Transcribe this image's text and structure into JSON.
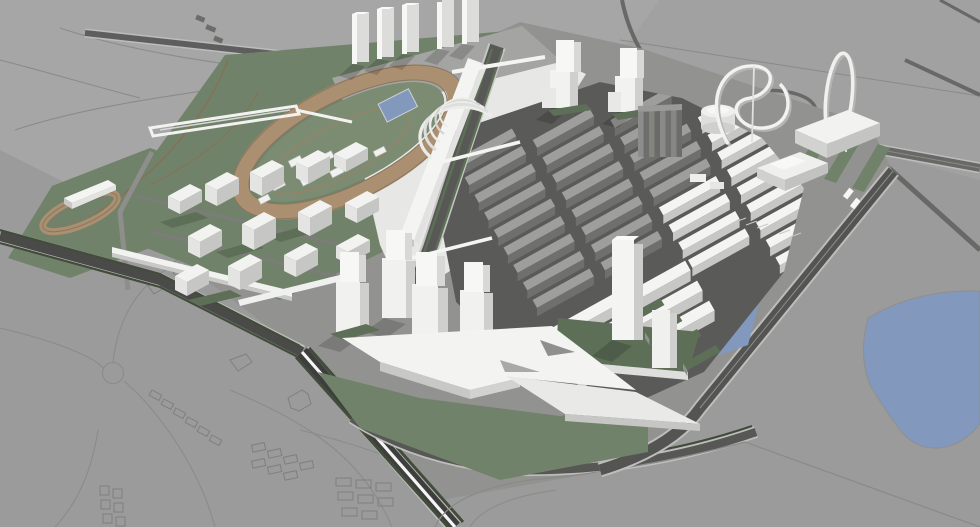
{
  "meta": {
    "title": "Aerial 3D massing render of an urban masterplan",
    "view": "bird's-eye perspective, monochrome massing model with landscape color accents",
    "site_features": [
      "horse racetrack with tan oval and landscaped infield pool",
      "grandstand with curved fan canopy along central boulevard",
      "row of five residential slab towers",
      "training track and stable barn on west meadow",
      "dense grid of housing slabs (gray existing phase, white new phase)",
      "ribbed dark high-rise cluster",
      "gas-holder cylinder landmark",
      "looping ribbon sculptures in landmark park",
      "large venue boxes at north-east",
      "stacked-cube tower groups",
      "white wedge exhibition hall on south lawn",
      "canal with green-roof finger piers",
      "eastern pond with organic shoreline",
      "perimeter boulevards with hedgerows and white median",
      "highway with loop ramp at top right",
      "outlined low-rise context neighborhood with roundabout at bottom left",
      "shuttle bus on east boundary road"
    ]
  },
  "colors": {
    "ground_base": "#9b9b9b",
    "ground_light": "#a6a6a6",
    "ground_mid": "#a1a1a1",
    "site_base": "#929290",
    "outline": "#7f7f7f",
    "context_line": "#8b8b8b",
    "road_dark": "#515151",
    "road_mid": "#686866",
    "road_pale": "#bdbdbb",
    "street_dark": "#5a5a58",
    "asphalt_deep": "#3e3e3e",
    "hedge": "#414c3b",
    "grass": "#71826a",
    "grass_dark": "#5e6f57",
    "grass_pale": "#7b8c72",
    "track_tan": "#aa9070",
    "track_line": "#8a7560",
    "water": "#8298bc",
    "bldg_top": "#f4f4f2",
    "bldg_side": "#e2e2e0",
    "bldg_shade": "#c7c7c5",
    "gray_top": "#9e9e9c",
    "gray_side": "#6f6f6d",
    "median": "#f5f5f3",
    "canopy": "#ececea"
  },
  "counts": {
    "north_slab_towers": 5,
    "ribbon_sculptures": 2,
    "housing_slabs_gray": 20,
    "housing_slabs_white": 19,
    "finger_piers": 4
  }
}
